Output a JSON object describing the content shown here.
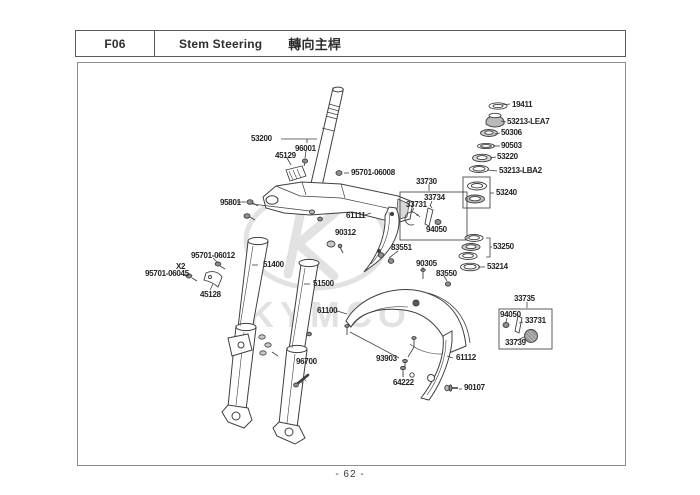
{
  "header": {
    "code": "F06",
    "title_en": "Stem Steering",
    "title_zh": "轉向主桿"
  },
  "footer": {
    "page_number": "- 62 -"
  },
  "watermark": {
    "brand": "KYMCO"
  },
  "colors": {
    "line": "#3f3f3f",
    "label_text": "#232323",
    "watermark": "#e2e2e2",
    "group_box_border": "#4a4a4a",
    "page_border": "#8d8d8d"
  },
  "parts": {
    "19411": "19411",
    "53213-LEA7": "53213-LEA7",
    "50306": "50306",
    "90503": "90503",
    "53220": "53220",
    "53213-LBA2": "53213-LBA2",
    "53240": "53240",
    "53250": "53250",
    "53214": "53214",
    "53200": "53200",
    "96001": "96001",
    "45129": "45129",
    "95701-06008": "95701-06008",
    "95801": "95801",
    "61111": "61111",
    "90312": "90312",
    "33730": "33730",
    "33734": "33734",
    "33731": "33731",
    "94050": "94050",
    "83551": "83551",
    "90305": "90305",
    "83550": "83550",
    "95701-06012": "95701-06012",
    "X2": "X2",
    "95701-06045": "95701-06045",
    "45128": "45128",
    "51400": "51400",
    "51500": "51500",
    "96700": "96700",
    "61100": "61100",
    "93903": "93903",
    "64222": "64222",
    "61112": "61112",
    "90107": "90107",
    "33735": "33735",
    "33739": "33739"
  }
}
